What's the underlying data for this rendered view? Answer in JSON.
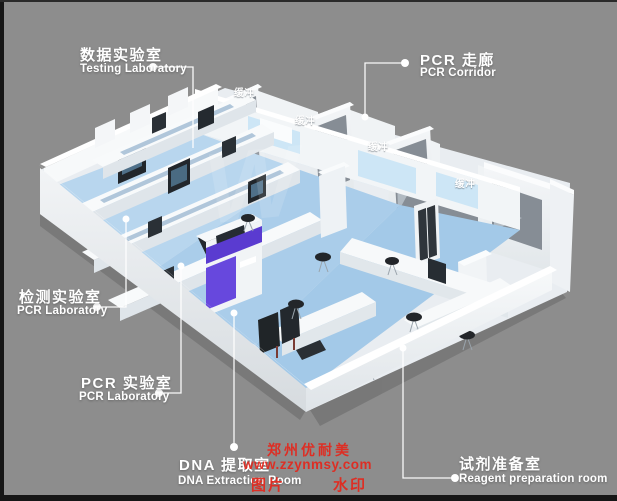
{
  "page": {
    "title": "PCR实验室三维布局图"
  },
  "labels": {
    "testing_lab": {
      "zh": "数据实验室",
      "en": "Testing Laboratory"
    },
    "pcr_corridor": {
      "zh": "PCR 走廊",
      "en": "PCR Corridor"
    },
    "pcr_lab": {
      "zh": "检测实验室",
      "en": "PCR Laboratory"
    },
    "pcr_lab2": {
      "zh": "PCR 实验室",
      "en": "PCR Laboratory"
    },
    "dna_room": {
      "zh": "DNA 提取室",
      "en": "DNA Extraction Room"
    },
    "reagent_room": {
      "zh": "试剂准备室",
      "en": "Reagent preparation room"
    }
  },
  "room_tags": {
    "buffer": "缓冲"
  },
  "watermark": {
    "brand": "郑州优耐美",
    "url": "www.zzynmsy.com",
    "tag_left": "图片",
    "tag_right": "水印",
    "logo": "W"
  },
  "colors": {
    "background": "#8d8d8d",
    "floor_blue": "#b3d3ee",
    "corridor_blue": "#c2ddf2",
    "accent_purple": "#5a3bd0",
    "watermark_red": "#e4271c",
    "label_white": "#ffffff",
    "window_gray": "#8a9199"
  }
}
